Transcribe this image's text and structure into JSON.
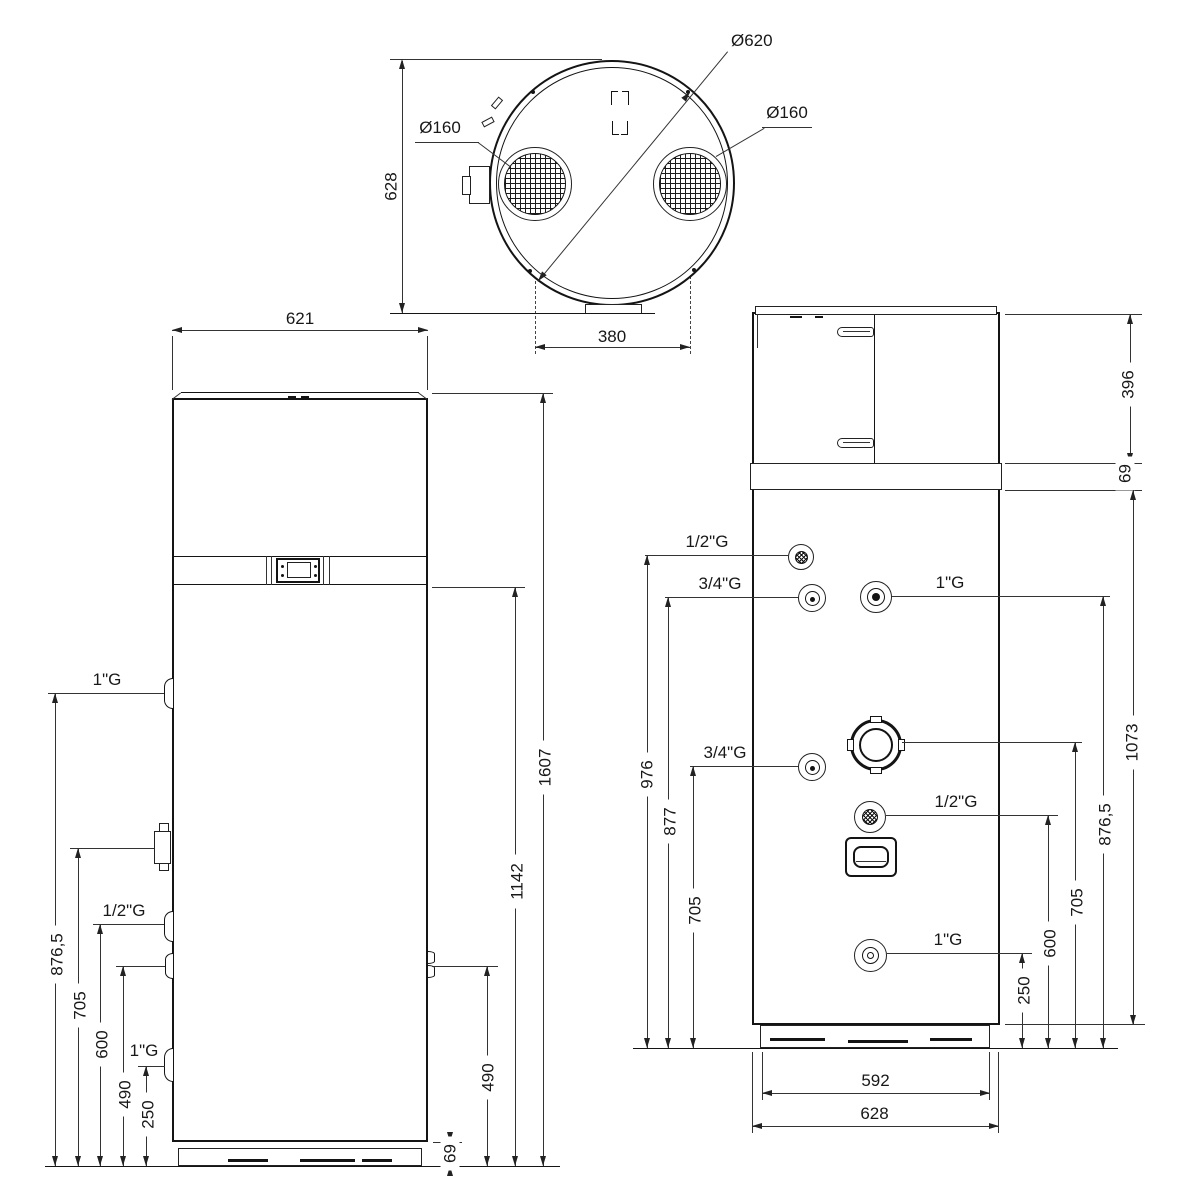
{
  "top_view": {
    "overall_dia": "Ø620",
    "grille_left_dia": "Ø160",
    "grille_right_dia": "Ø160",
    "depth": "628",
    "duct_spacing": "380"
  },
  "front_view": {
    "width": "621",
    "height_total": "1607",
    "height_band": "1142",
    "height_latch": "490",
    "height_plinth": "69",
    "ports": {
      "top": "1\"G",
      "middle": "1/2\"G",
      "bottom": "1\"G"
    },
    "heights": {
      "h1": "876,5",
      "h2": "705",
      "h3": "600",
      "h4": "490",
      "h5": "250"
    }
  },
  "side_view": {
    "height_top_section": "396",
    "height_band": "69",
    "height_tank": "1073",
    "ports": {
      "p1": "1/2\"G",
      "p2": "3/4\"G",
      "p3": "1\"G",
      "p4": "3/4\"G",
      "p5": "1/2\"G",
      "p6": "1\"G"
    },
    "heights_left": {
      "h1": "976",
      "h2": "877",
      "h3": "705"
    },
    "heights_right": {
      "h1": "876,5",
      "h2": "705",
      "h3": "600",
      "h4": "250"
    },
    "width_base": "592",
    "width_overall": "628"
  }
}
